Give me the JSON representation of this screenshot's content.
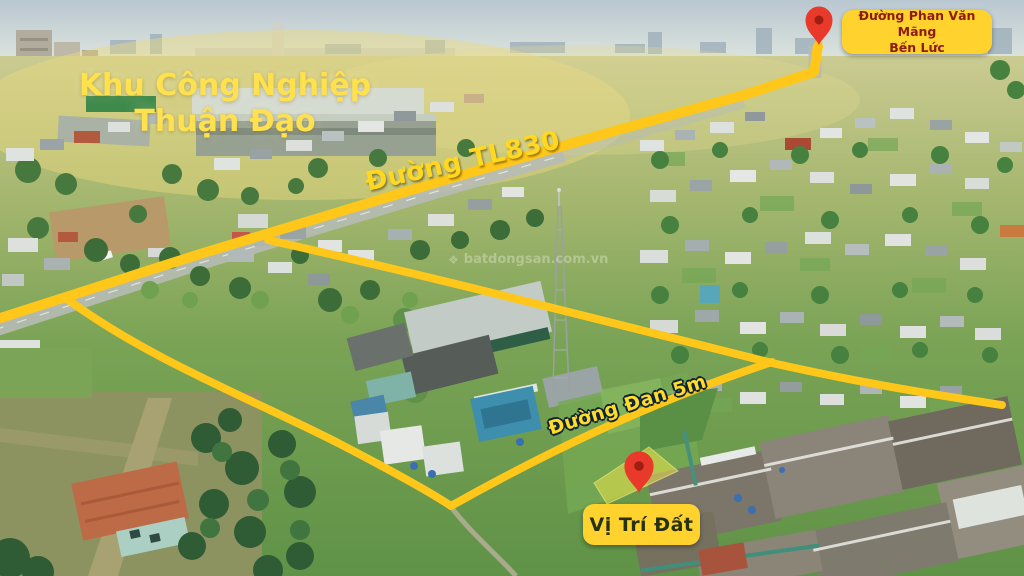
{
  "annotations": {
    "industrial_zone": {
      "line1": "Khu Công Nghiệp",
      "line2": "Thuận Đạo"
    },
    "road_tl830": {
      "label": "Đường TL830"
    },
    "road_dan": {
      "label": "Đường Đan 5m"
    },
    "road_phan_van_mang": {
      "line1": "Đường Phan Văn Mãng",
      "line2": "Bến Lức"
    },
    "plot_marker": {
      "label": "Vị Trí Đất"
    },
    "watermark": {
      "icon": "❖",
      "text": "batdongsan.com.vn"
    }
  },
  "colors": {
    "road_yellow": "#FFC71A",
    "text_yellow": "#FFE14D",
    "tl830_yellow": "#FFD81F",
    "dan_yellow": "#FFDC26",
    "badge_bg": "#FFD22E",
    "badge_text_red": "#8E1B10",
    "badge_text_dark": "#26310D",
    "pin_red": "#E8392B",
    "pin_inner": "#9C1F12",
    "parcel_highlight": "#ECE14A",
    "outline_dark": "#0E2238"
  }
}
